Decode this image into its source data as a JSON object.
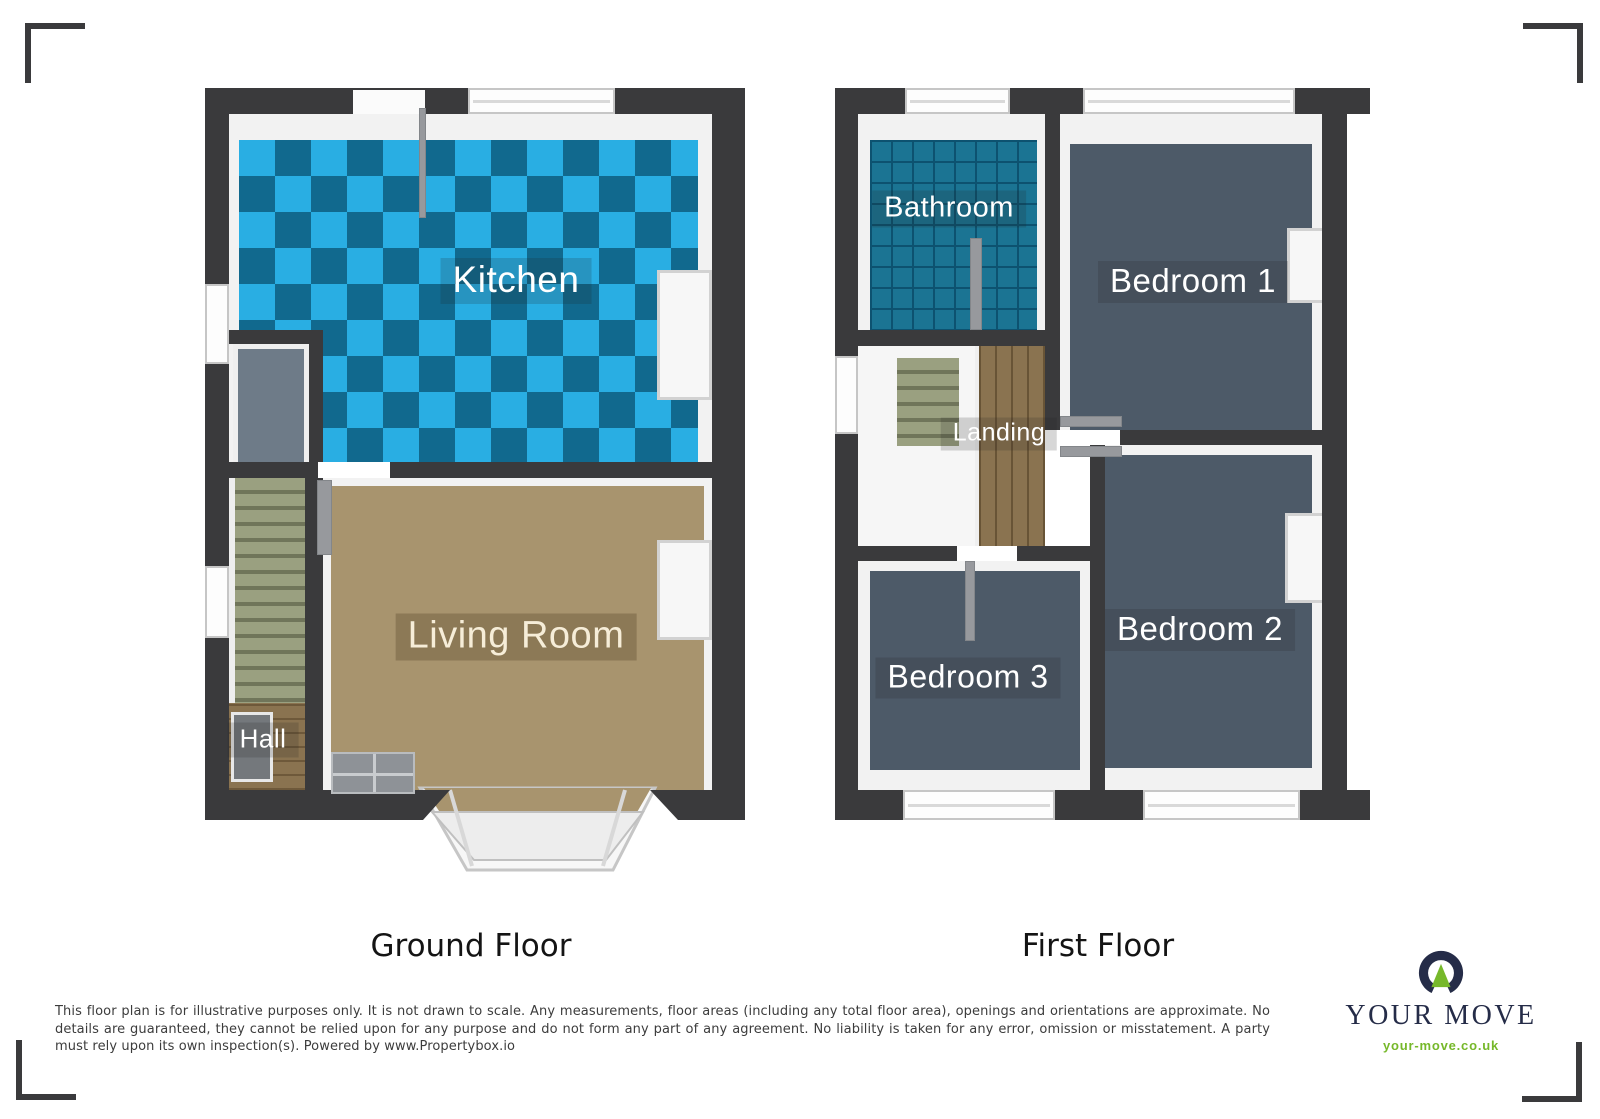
{
  "floorplan": {
    "ground_floor": {
      "caption": "Ground Floor",
      "rooms": [
        {
          "name": "Kitchen"
        },
        {
          "name": "Living Room"
        },
        {
          "name": "Hall"
        }
      ]
    },
    "first_floor": {
      "caption": "First Floor",
      "rooms": [
        {
          "name": "Bathroom"
        },
        {
          "name": "Bedroom 1"
        },
        {
          "name": "Bedroom 2"
        },
        {
          "name": "Bedroom 3"
        },
        {
          "name": "Landing"
        }
      ]
    }
  },
  "disclaimer": "This floor plan is for illustrative purposes only. It is not drawn to scale. Any measurements, floor areas (including any total floor area), openings and orientations are approximate. No details are guaranteed, they cannot be relied upon for any purpose and do not form any part of any agreement. No liability is taken for any error, omission or misstatement. A party must rely upon its own inspection(s). Powered by www.Propertybox.io",
  "branding": {
    "name": "YOUR MOVE",
    "website": "your-move.co.uk"
  },
  "colors": {
    "wall": "#3a3a3c",
    "kitchen_tile_light": "#29aee3",
    "kitchen_tile_dark": "#11698e",
    "bathroom_tile": "#1b7493",
    "bathroom_grout": "#0d5270",
    "bedroom_carpet": "#4d5a68",
    "living_carpet": "#a8946e",
    "wood": "#8a7350",
    "stairs": "#9aa080",
    "label_text": "#ffffff",
    "caption_text": "#141414",
    "disclaimer_text": "#3c3c3c",
    "brand_navy": "#252c48",
    "brand_green": "#76b82a"
  }
}
